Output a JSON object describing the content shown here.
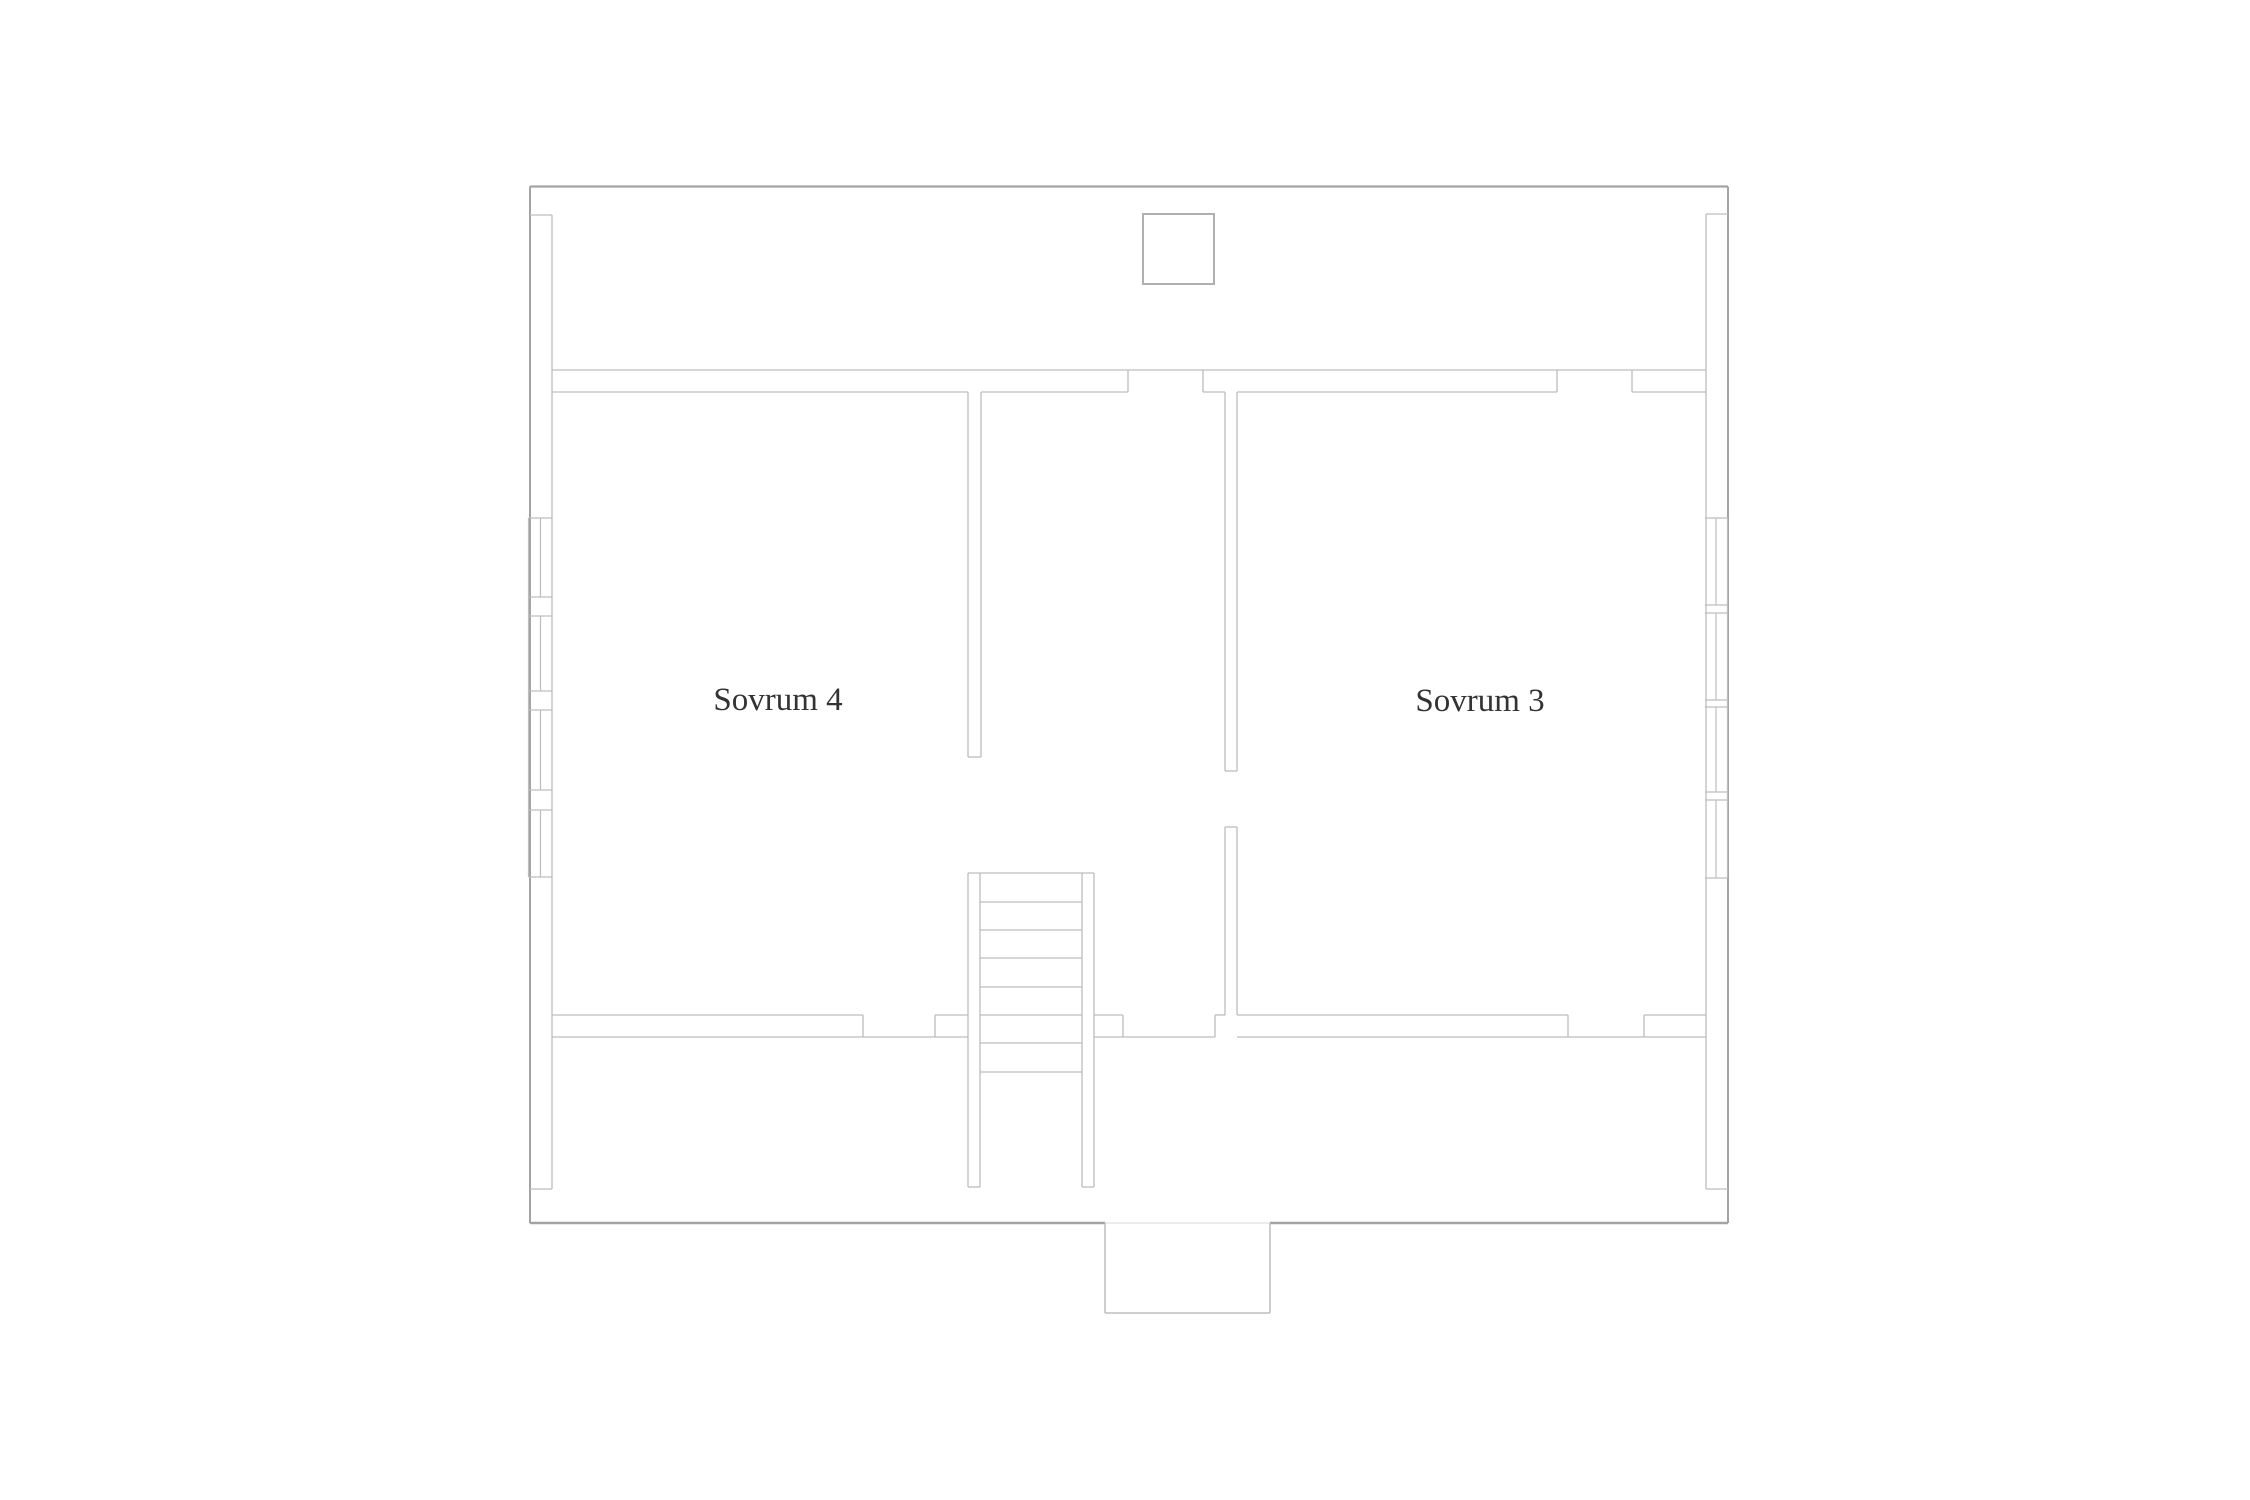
{
  "canvas": {
    "width": 2250,
    "height": 1500,
    "background": "#ffffff"
  },
  "palette": {
    "wall": "#bdbdbd",
    "outer": "#a3a3a3",
    "window": "#bdbdbd",
    "faint": "#d8d8d8",
    "chimney": "#b0b0b0",
    "label_text": "#333333"
  },
  "floor_plan": {
    "rooms": [
      {
        "id": "sovrum-4",
        "label": "Sovrum 4",
        "x": 778,
        "y": 700
      },
      {
        "id": "sovrum-3",
        "label": "Sovrum 3",
        "x": 1480,
        "y": 701
      }
    ],
    "chimney": {
      "x": 1143,
      "y": 214,
      "w": 71,
      "h": 70,
      "stroke": 2
    },
    "stair_treads": {
      "x1": 980,
      "x2": 1082,
      "ys": [
        902,
        930,
        958,
        987,
        1015,
        1043,
        1072
      ]
    },
    "windows": [
      {
        "side": "left",
        "outer_x": 528.5,
        "inner_x": 552,
        "mullion_x": 540.5,
        "top": 518,
        "bottom": 877,
        "dividers": [
          597,
          616,
          691,
          710,
          790,
          810
        ],
        "panes": [
          [
            518,
            597
          ],
          [
            616,
            691
          ],
          [
            710,
            790
          ],
          [
            810,
            877
          ]
        ]
      },
      {
        "side": "right",
        "outer_x": 1727.5,
        "inner_x": 1705,
        "mullion_x": 1716,
        "top": 518,
        "bottom": 878,
        "dividers": [
          605,
          613,
          700,
          707,
          792,
          800
        ],
        "panes": [
          [
            518,
            605
          ],
          [
            613,
            700
          ],
          [
            707,
            792
          ],
          [
            800,
            878
          ]
        ]
      }
    ],
    "lines": [
      [
        530,
        186.5,
        1728,
        186.5,
        2.2,
        "outer"
      ],
      [
        530,
        186.5,
        530,
        1223,
        2,
        "outer"
      ],
      [
        1728,
        186.5,
        1728,
        1223,
        2,
        "outer"
      ],
      [
        530,
        1223,
        1105,
        1223,
        2.5,
        "outer"
      ],
      [
        1270,
        1223,
        1728,
        1223,
        2.5,
        "outer"
      ],
      [
        1105,
        1223,
        1270,
        1223,
        1,
        "faint"
      ],
      [
        1105,
        1223,
        1105,
        1313,
        1.5,
        "wall"
      ],
      [
        1105,
        1313,
        1270,
        1313,
        1.5,
        "wall"
      ],
      [
        1270,
        1223,
        1270,
        1313,
        1.5,
        "wall"
      ],
      [
        552,
        215,
        552,
        1189,
        1.3,
        "wall"
      ],
      [
        1706,
        214,
        1706,
        1189,
        1.3,
        "wall"
      ],
      [
        530,
        215,
        552,
        215,
        1.3,
        "wall"
      ],
      [
        1706,
        214,
        1728,
        214,
        1.3,
        "wall"
      ],
      [
        530,
        1189,
        552,
        1189,
        1.3,
        "wall"
      ],
      [
        1706,
        1189,
        1728,
        1189,
        1.3,
        "wall"
      ],
      [
        552,
        370,
        1706,
        370,
        1.3,
        "wall"
      ],
      [
        552,
        392,
        968,
        392,
        1.3,
        "wall"
      ],
      [
        981,
        392,
        1128,
        392,
        1.3,
        "wall"
      ],
      [
        1203,
        392,
        1225,
        392,
        1.3,
        "wall"
      ],
      [
        1237,
        392,
        1557,
        392,
        1.3,
        "wall"
      ],
      [
        1632,
        392,
        1706,
        392,
        1.3,
        "wall"
      ],
      [
        1128,
        370,
        1128,
        392,
        1.3,
        "wall"
      ],
      [
        1203,
        370,
        1203,
        392,
        1.3,
        "wall"
      ],
      [
        1557,
        370,
        1557,
        392,
        1.3,
        "wall"
      ],
      [
        1632,
        370,
        1632,
        392,
        1.3,
        "wall"
      ],
      [
        968,
        392,
        968,
        757,
        1.3,
        "wall"
      ],
      [
        981,
        392,
        981,
        757,
        1.3,
        "wall"
      ],
      [
        968,
        757,
        981,
        757,
        1.3,
        "wall"
      ],
      [
        1225,
        392,
        1225,
        771,
        1.3,
        "wall"
      ],
      [
        1237,
        392,
        1237,
        771,
        1.3,
        "wall"
      ],
      [
        1225,
        771,
        1237,
        771,
        1.3,
        "wall"
      ],
      [
        1225,
        827,
        1225,
        1015,
        1.3,
        "wall"
      ],
      [
        1237,
        827,
        1237,
        1015,
        1.3,
        "wall"
      ],
      [
        1225,
        827,
        1237,
        827,
        1.3,
        "wall"
      ],
      [
        968,
        873,
        1094,
        873,
        1.3,
        "wall"
      ],
      [
        968,
        873,
        968,
        1187,
        1.3,
        "wall"
      ],
      [
        980,
        873,
        980,
        1187,
        1.3,
        "wall"
      ],
      [
        1082,
        873,
        1082,
        1187,
        1.3,
        "wall"
      ],
      [
        1094,
        873,
        1094,
        1187,
        1.3,
        "wall"
      ],
      [
        968,
        1187,
        980,
        1187,
        1.3,
        "wall"
      ],
      [
        1082,
        1187,
        1094,
        1187,
        1.3,
        "wall"
      ],
      [
        552,
        1015,
        863,
        1015,
        1.3,
        "wall"
      ],
      [
        935,
        1015,
        968,
        1015,
        1.3,
        "wall"
      ],
      [
        1094,
        1015,
        1123,
        1015,
        1.3,
        "wall"
      ],
      [
        1215,
        1015,
        1225,
        1015,
        1.3,
        "wall"
      ],
      [
        1237,
        1015,
        1568,
        1015,
        1.3,
        "wall"
      ],
      [
        1644,
        1015,
        1706,
        1015,
        1.3,
        "wall"
      ],
      [
        552,
        1037,
        968,
        1037,
        1.3,
        "wall"
      ],
      [
        1094,
        1037,
        1215,
        1037,
        1.3,
        "wall"
      ],
      [
        1237,
        1037,
        1706,
        1037,
        1.3,
        "wall"
      ],
      [
        863,
        1015,
        863,
        1037,
        1.3,
        "wall"
      ],
      [
        935,
        1015,
        935,
        1037,
        1.3,
        "wall"
      ],
      [
        1123,
        1015,
        1123,
        1037,
        1.3,
        "wall"
      ],
      [
        1215,
        1015,
        1215,
        1037,
        1.3,
        "wall"
      ],
      [
        1568,
        1015,
        1568,
        1037,
        1.3,
        "wall"
      ],
      [
        1644,
        1015,
        1644,
        1037,
        1.3,
        "wall"
      ]
    ]
  }
}
